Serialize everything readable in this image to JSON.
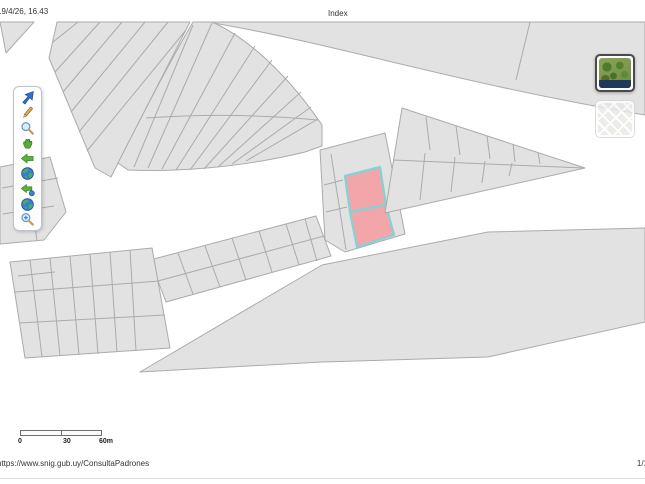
{
  "header": {
    "datetime": "19/4/26, 16.43",
    "title": "Index"
  },
  "footer": {
    "url": "https://www.snig.gub.uy/ConsultaPadrones",
    "page_number": "1/1"
  },
  "map": {
    "scale_bar": {
      "labels": [
        "0",
        "30",
        "60m"
      ]
    },
    "colors": {
      "parcel_fill": "#e2e2e2",
      "parcel_stroke": "#ababab",
      "highlight_fill": "#f2a6a9",
      "highlight_stroke": "#82d2d8"
    },
    "selected_parcels": 2
  },
  "toolbar": {
    "tools": [
      {
        "name": "select",
        "icon": "cursor-icon"
      },
      {
        "name": "measure",
        "icon": "pencil-icon"
      },
      {
        "name": "zoom-box",
        "icon": "magnifier-icon"
      },
      {
        "name": "pan",
        "icon": "hand-icon"
      },
      {
        "name": "previous-extent",
        "icon": "arrow-left-icon"
      },
      {
        "name": "full-extent",
        "icon": "globe-icon"
      },
      {
        "name": "extent-history",
        "icon": "arrow-left-globe-icon"
      },
      {
        "name": "world-view",
        "icon": "globe-icon"
      },
      {
        "name": "zoom-in",
        "icon": "magnifier-plus-icon"
      }
    ]
  },
  "basemaps": [
    {
      "name": "satellite",
      "selected": true
    },
    {
      "name": "streets",
      "selected": false
    }
  ]
}
